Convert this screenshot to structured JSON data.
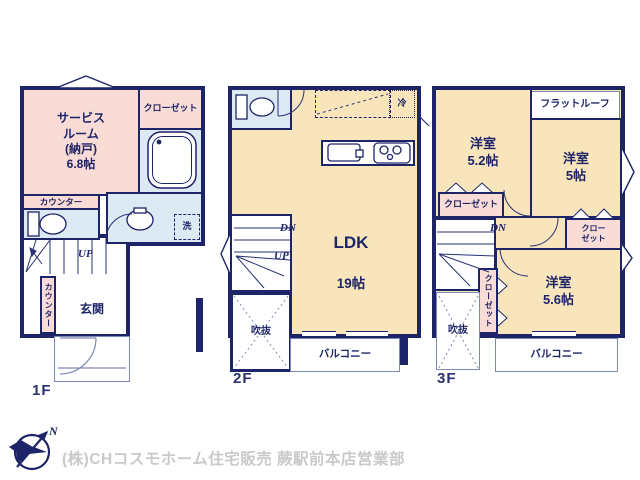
{
  "footer": {
    "company": "(株)CHコスモホーム住宅販売 蕨駅前本店営業部"
  },
  "compass": {
    "north": "N"
  },
  "f1": {
    "floor_label": "1F",
    "service_room": "サービス\nルーム\n(納戸)\n6.8帖",
    "closet": "クローゼット",
    "counter_top": "カウンター",
    "counter_side": "カウンター",
    "laundry": "洗",
    "stairs_up": "UP",
    "entrance": "玄関"
  },
  "f2": {
    "floor_label": "2F",
    "ldk_name": "LDK",
    "ldk_size": "19帖",
    "fridge": "冷",
    "stairs_dn": "DN",
    "stairs_up": "UP",
    "void": "吹抜",
    "balcony": "バルコニー"
  },
  "f3": {
    "floor_label": "3F",
    "flat_roof": "フラットルーフ",
    "room_a": "洋室\n5.2帖",
    "room_b": "洋室\n5帖",
    "room_c": "洋室\n5.6帖",
    "closet_a": "クローゼット",
    "closet_b": "クロー\nゼット",
    "closet_c": "クローゼット",
    "stairs_dn": "DN",
    "void": "吹抜",
    "balcony": "バルコニー"
  }
}
